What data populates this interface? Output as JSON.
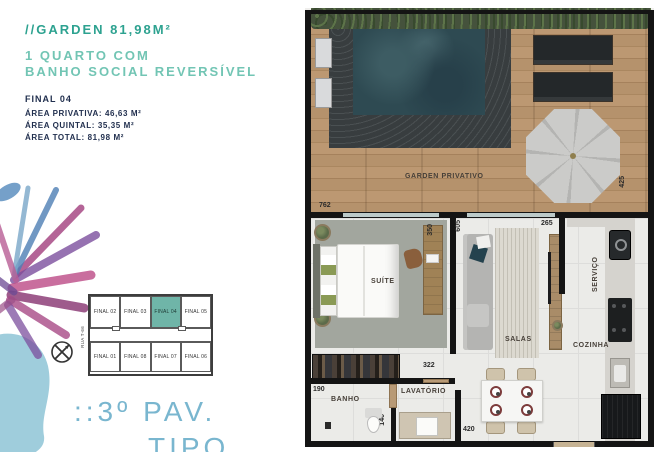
{
  "header": {
    "title": "//GARDEN 81,98M²",
    "subtitle_line1": "1 QUARTO COM",
    "subtitle_line2": "BANHO SOCIAL REVERSÍVEL",
    "unit": "FINAL 04",
    "area_privativa": "ÁREA PRIVATIVA: 46,63 M²",
    "area_quintal": "ÁREA QUINTAL: 35,35 M²",
    "area_total": "ÁREA TOTAL: 81,98 M²"
  },
  "keyplan": {
    "street": "RUA T-66",
    "units_top": [
      "FINAL 02",
      "FINAL 03",
      "FINAL 04",
      "FINAL 05"
    ],
    "units_bottom": [
      "FINAL 01",
      "FINAL 08",
      "FINAL 07",
      "FINAL 06"
    ],
    "highlighted_unit": "FINAL 04"
  },
  "footer": {
    "line1": "::3º PAV.",
    "line2": "TIPO"
  },
  "plan": {
    "garden_label": "GARDEN PRIVATIVO",
    "rooms": {
      "suite": "SUÍTE",
      "salas": "SALAS",
      "cozinha": "COZINHA",
      "servico": "SERVIÇO",
      "banho": "BANHO",
      "lavatorio": "LAVATÓRIO"
    },
    "dims": {
      "garden_width": "762",
      "garden_depth": "425",
      "sala_height": "605",
      "suite_desk": "350",
      "sala_width": "265",
      "servico_width": "140",
      "suite_width": "322",
      "banho_width": "190",
      "banho_depth": "140",
      "entry_width": "420"
    }
  },
  "colors": {
    "accent_teal": "#2da290",
    "accent_teal_light": "#72c5b4",
    "navy": "#22304f",
    "footer_blue": "#79b6cf",
    "keyplan_highlight": "#6fb5a8"
  }
}
